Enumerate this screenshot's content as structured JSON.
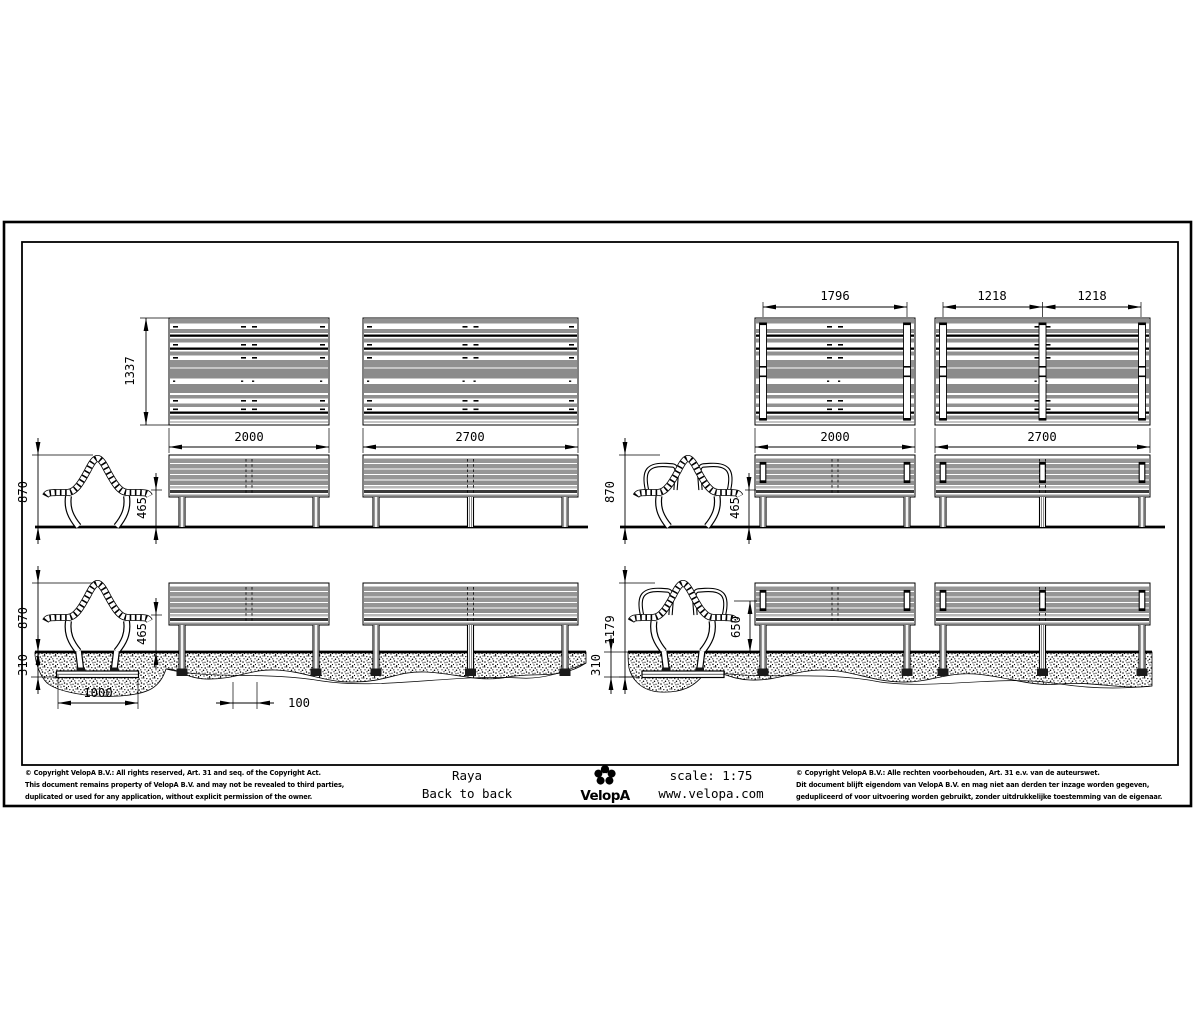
{
  "title_block": {
    "product": "Raya",
    "variant": "Back to back",
    "brand": "VelopA",
    "scale": "scale: 1:75",
    "website": "www.velopa.com",
    "copyright_left": [
      "© Copyright VelopA B.V.: All rights reserved, Art. 31 and seq. of the Copyright Act.",
      "This document remains property of VelopA B.V. and may not be revealed to third parties,",
      "duplicated or used for any application, without explicit permission of the owner."
    ],
    "copyright_right": [
      "© Copyright VelopA B.V.: Alle rechten voorbehouden, Art. 31 e.v. van de auteurswet.",
      "Dit document blijft eigendom van VelopA B.V. en mag niet aan derden ter inzage worden gegeven,",
      "gedupliceerd of voor uitvoering worden gebruikt, zonder uitdrukkelijke toestemming van de eigenaar."
    ]
  },
  "dimensions_mm": {
    "plan_depth": "1337",
    "length_short": "2000",
    "length_long": "2700",
    "armrest_pitch_short": "1796",
    "armrest_pitch_long": "1218",
    "overall_height": "870",
    "seat_height": "465",
    "armrest_height": "650",
    "foundation_depth": "310",
    "foundation_length": "1000",
    "center_offset": "100",
    "height_incl_foundation": "1179"
  },
  "drawing_colors": {
    "line": "#000000",
    "slat_gray": "#919191",
    "dark_rail": "#3a3a3a",
    "background": "#ffffff"
  }
}
